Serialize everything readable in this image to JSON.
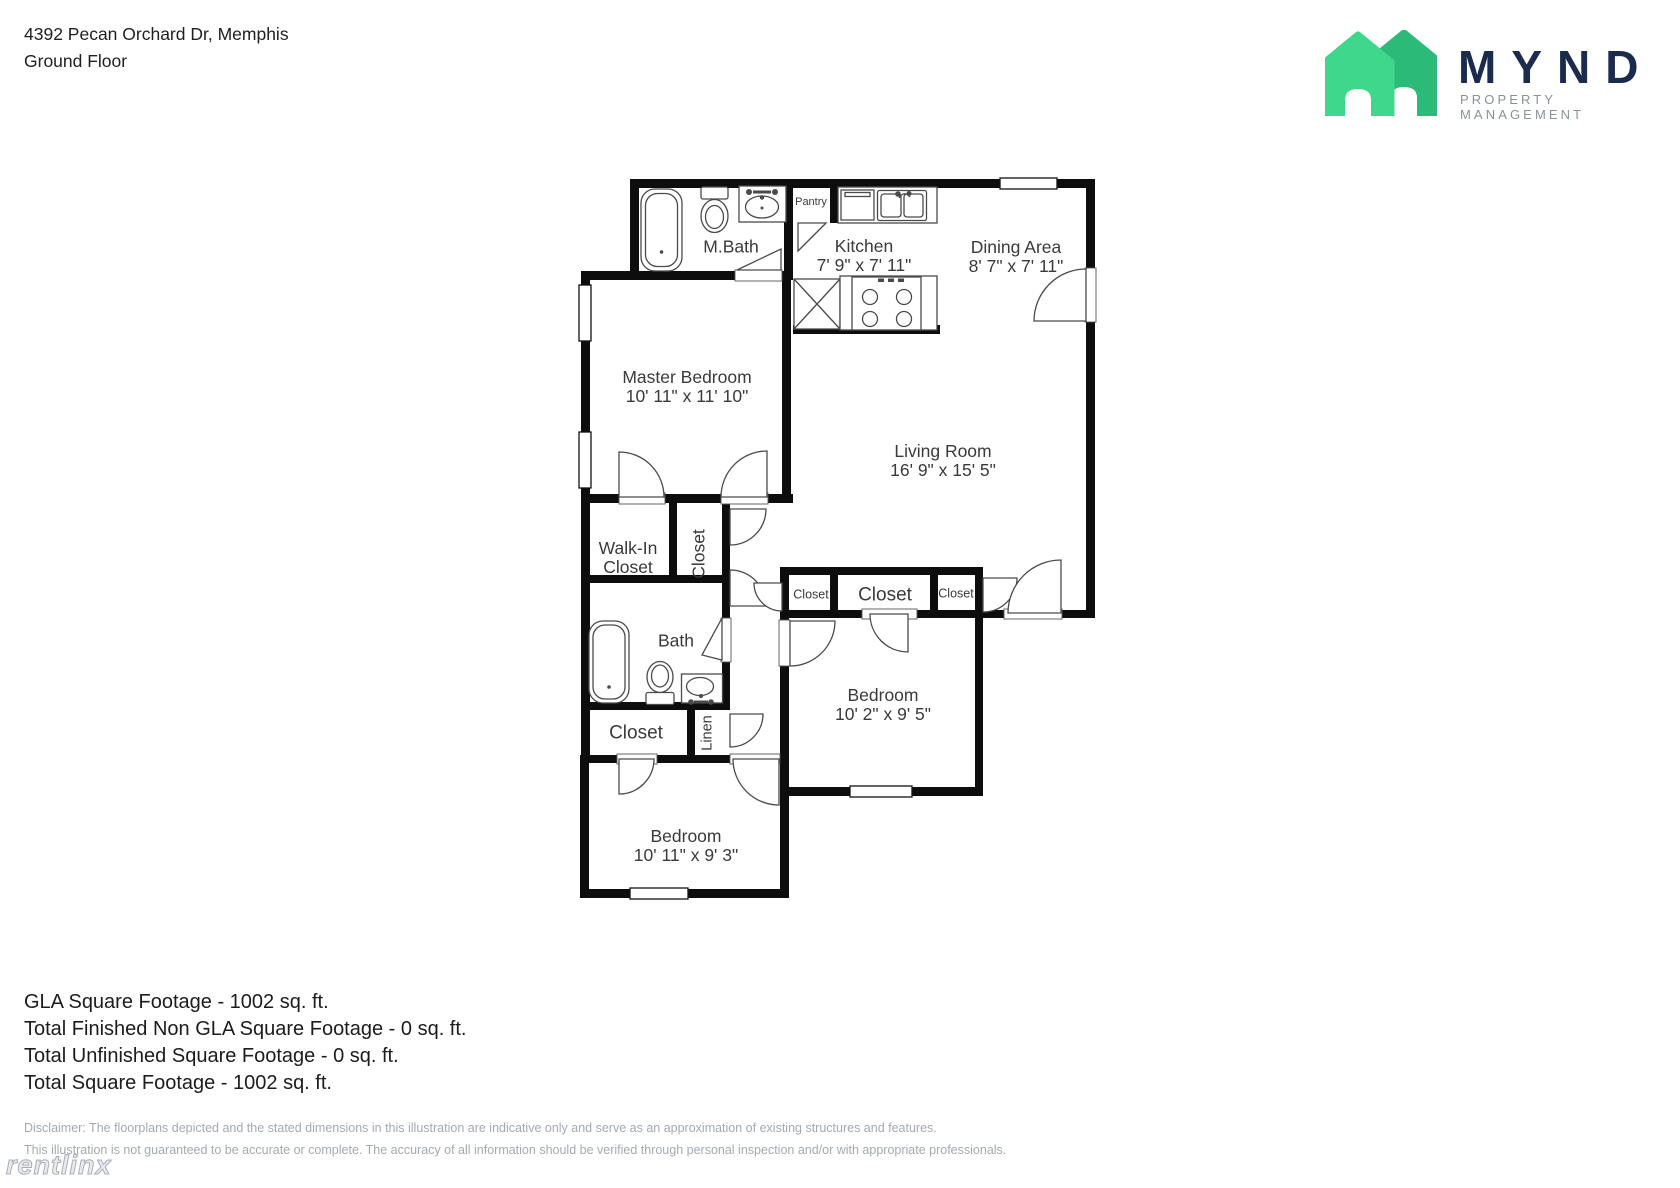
{
  "header": {
    "address": "4392 Pecan Orchard Dr, Memphis",
    "floor_label": "Ground Floor",
    "brand": "MYND",
    "brand_subtitle": "PROPERTY MANAGEMENT"
  },
  "plan": {
    "rooms": [
      {
        "name": "Master Bedroom",
        "dims": "10' 11\" x 11' 10\""
      },
      {
        "name": "Living Room",
        "dims": "16' 9\" x 15' 5\""
      },
      {
        "name": "Kitchen",
        "dims": "7' 9\" x 7' 11\""
      },
      {
        "name": "Dining Area",
        "dims": "8' 7\" x 7' 11\""
      },
      {
        "name": "M.Bath"
      },
      {
        "name": "Pantry"
      },
      {
        "name": "Walk-In Closet"
      },
      {
        "name": "Closet"
      },
      {
        "name": "Bath"
      },
      {
        "name": "Closet"
      },
      {
        "name": "Linen"
      },
      {
        "name": "Bedroom",
        "dims": "10' 11\" x 9' 3\""
      },
      {
        "name": "Closet"
      },
      {
        "name": "Closet"
      },
      {
        "name": "Closet"
      },
      {
        "name": "Bedroom",
        "dims": "10' 2\" x 9' 5\""
      }
    ]
  },
  "footer": {
    "summary_lines": [
      "GLA Square Footage - 1002 sq. ft.",
      "Total Finished Non GLA Square Footage - 0 sq. ft.",
      "Total Unfinished Square Footage - 0 sq. ft.",
      "Total Square Footage - 1002 sq. ft."
    ],
    "disclaimer_line1": "Disclaimer: The floorplans depicted and the stated dimensions in this illustration are indicative only and serve as an approximation of existing structures and features.",
    "disclaimer_line2": "This illustration is not guaranteed to be accurate or complete. The accuracy of all information should be verified through personal inspection and/or with appropriate professionals.",
    "watermark": "rentlinx"
  },
  "colors": {
    "house_front_green": "#3FD78C",
    "house_back_green": "#2CBA79",
    "brand_navy": "#1B2B4D",
    "brand_gray": "#8A919C",
    "wall_black": "#0D0D0D",
    "label_gray": "#3A3A3A",
    "disclaimer_gray": "#A3A9B3"
  }
}
